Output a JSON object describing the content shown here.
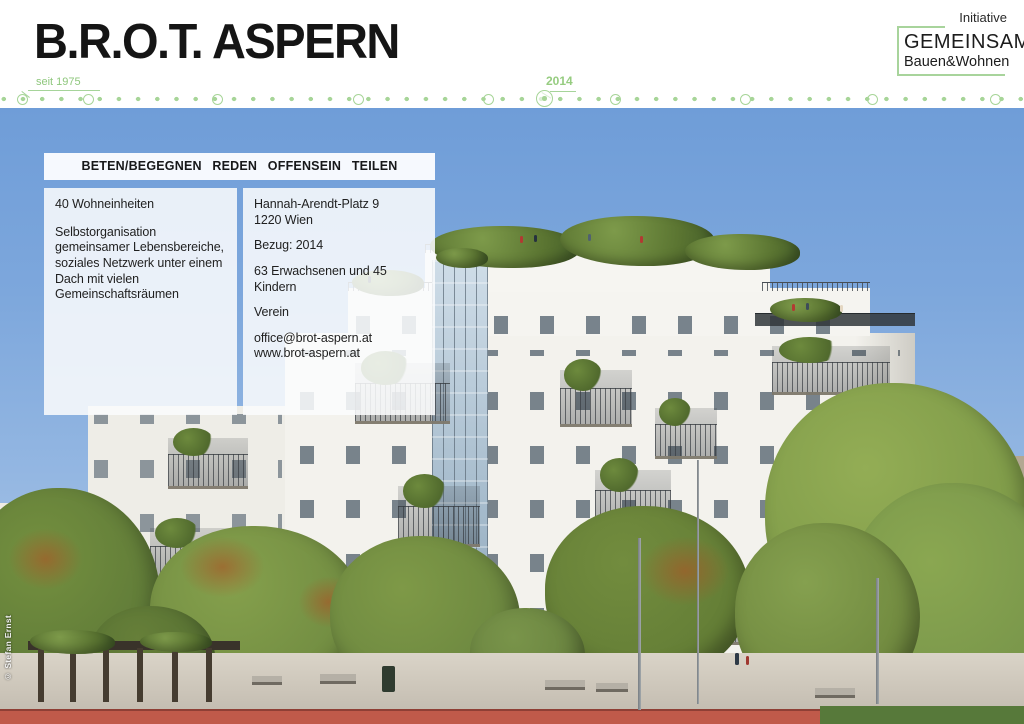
{
  "header": {
    "title": "B.R.O.T. ASPERN",
    "since_label": "seit 1975",
    "year_label": "2014",
    "logo": {
      "line1": "Initiative",
      "line2": "GEMEINSAM",
      "line3": "Bauen&Wohnen"
    }
  },
  "info": {
    "banner": "BETEN/BEGEGNEN REDEN OFFENSEIN TEILEN",
    "left_box": {
      "line1": "40 Wohneinheiten",
      "paragraph": "Selbstorganisation gemeinsamer Lebensbereiche, soziales Netzwerk unter einem Dach mit vielen Gemeinschaftsräumen"
    },
    "right_box": {
      "address_line1": "Hannah-Arendt-Platz 9",
      "address_line2": "1220 Wien",
      "occupancy": "Bezug: 2014",
      "residents": "63 Erwachsenen und 45 Kindern",
      "org_type": "Verein",
      "email": "office@brot-aspern.at",
      "website": "www.brot-aspern.at"
    }
  },
  "photo": {
    "credit": "© Stefan Ernst"
  },
  "colors": {
    "accent_green": "#a7d598",
    "label_green": "#8fc77d",
    "sky_blue": "#6f9dd8",
    "track_red": "#c05a4a"
  }
}
